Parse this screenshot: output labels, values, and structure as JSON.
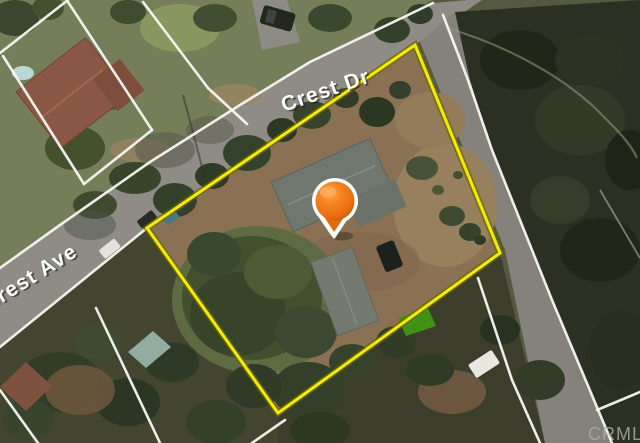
{
  "map": {
    "view_type": "satellite",
    "streets": {
      "crest": "Crest Dr",
      "forest": "Forest Ave"
    },
    "watermark": "CRMLS",
    "marker": {
      "kind": "property-location-pin",
      "color": "#ee7514"
    },
    "overlay": {
      "boundary_color": "#f3eb00",
      "parcel_line_color": "#ffffff",
      "road_color": "#8e8c85"
    }
  }
}
